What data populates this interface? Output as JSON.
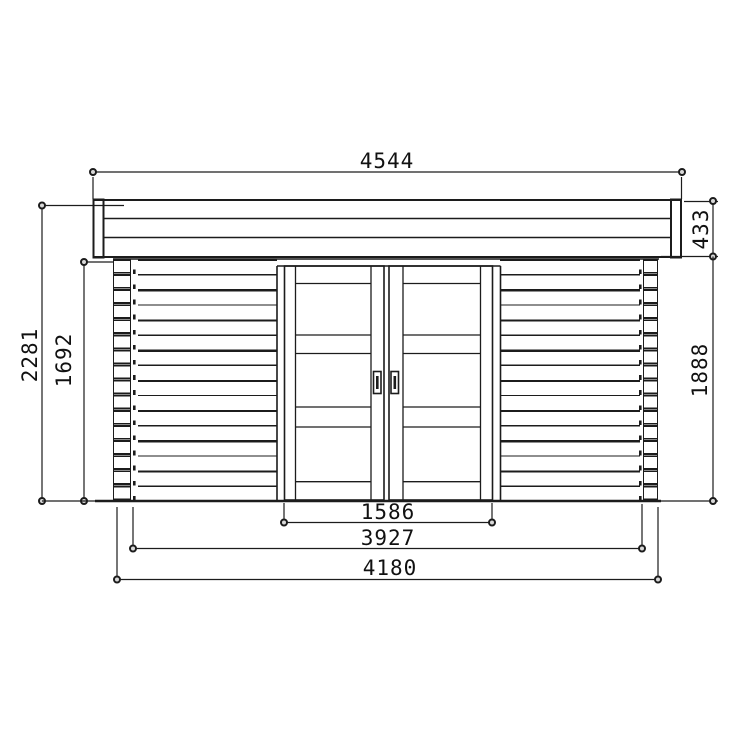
{
  "diagram": {
    "type": "technical-elevation-drawing",
    "subject": "log-cabin-front-elevation-with-double-doors",
    "background_color": "#ffffff",
    "line_color": "#1c1c1c",
    "dimensions": {
      "roof_width": "4544",
      "fascia_height": "433",
      "overall_height": "2281",
      "wall_log_height": "1692",
      "wall_height_right": "1888",
      "door_width": "1586",
      "wall_inner_width": "3927",
      "wall_outer_width": "4180"
    }
  }
}
